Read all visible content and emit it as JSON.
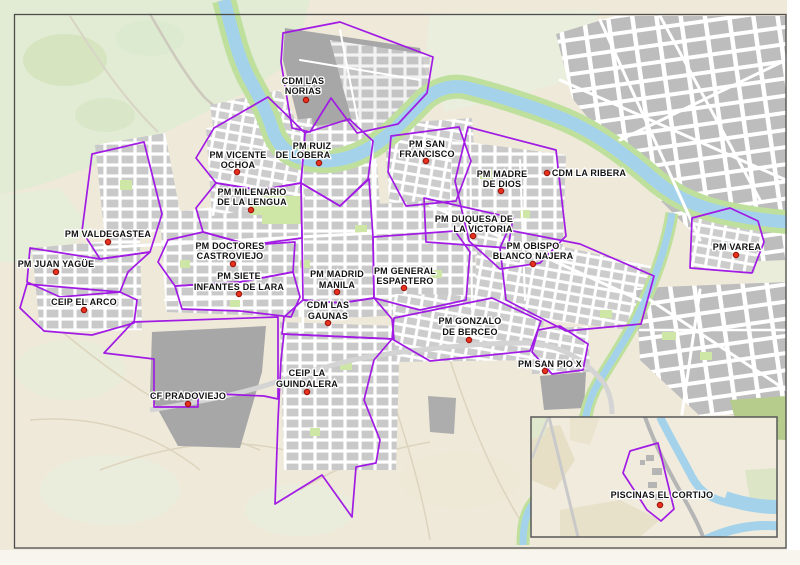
{
  "map": {
    "kind": "municipal sports facilities zone map",
    "colors": {
      "zone_boundary": "#A11BE4",
      "marker": "#E8311F",
      "river": "#A3D2EA",
      "park": "#BFE09C",
      "urban_block": "#C9C9C9",
      "industrial": "#A7A7A7",
      "farmland": "#EFE9DA",
      "countryside": "#E2EBD3",
      "border": "#4D4D4D"
    },
    "markers": [
      {
        "id": "cdm-las-norias",
        "label": "CDM LAS NORIAS",
        "line1": "CDM LAS",
        "line2": "NORIAS"
      },
      {
        "id": "pm-vicente-ochoa",
        "label": "PM VICENTE OCHOA",
        "line1": "PM VICENTE",
        "line2": "OCHOA"
      },
      {
        "id": "pm-ruiz-de-lobera",
        "label": "PM RUIZ DE LOBERA",
        "line1": "PM RUIZ",
        "line2": "DE LOBERA"
      },
      {
        "id": "pm-san-francisco",
        "label": "PM SAN FRANCISCO",
        "line1": "PM SAN",
        "line2": "FRANCISCO"
      },
      {
        "id": "pm-madre-de-dios",
        "label": "PM MADRE DE DIOS",
        "line1": "PM MADRE",
        "line2": "DE DIOS"
      },
      {
        "id": "cdm-la-ribera",
        "label": "CDM LA RIBERA",
        "line1": "CDM LA RIBERA"
      },
      {
        "id": "pm-milenario-de-la-lengua",
        "label": "PM MILENARIO DE LA LENGUA",
        "line1": "PM MILENARIO",
        "line2": "DE LA LENGUA"
      },
      {
        "id": "pm-duquesa-de-la-victoria",
        "label": "PM DUQUESA DE LA VICTORIA",
        "line1": "PM DUQUESA DE",
        "line2": "LA VICTORIA"
      },
      {
        "id": "pm-obispo-blanco-najera",
        "label": "PM OBISPO BLANCO NAJERA",
        "line1": "PM OBISPO",
        "line2": "BLANCO NAJERA"
      },
      {
        "id": "pm-varea",
        "label": "PM VAREA",
        "line1": "PM VAREA"
      },
      {
        "id": "pm-valdegastea",
        "label": "PM VALDEGASTEA",
        "line1": "PM VALDEGASTEA"
      },
      {
        "id": "pm-juan-yague",
        "label": "PM JUAN YAGÜE",
        "line1": "PM JUAN YAGÜE"
      },
      {
        "id": "ceip-el-arco",
        "label": "CEIP EL ARCO",
        "line1": "CEIP EL ARCO"
      },
      {
        "id": "pm-doctores-castroviejo",
        "label": "PM DOCTORES CASTROVIEJO",
        "line1": "PM DOCTORES",
        "line2": "CASTROVIEJO"
      },
      {
        "id": "pm-siete-infantes-de-lara",
        "label": "PM SIETE INFANTES DE LARA",
        "line1": "PM SIETE",
        "line2": "INFANTES DE LARA"
      },
      {
        "id": "pm-madrid-manila",
        "label": "PM MADRID MANILA",
        "line1": "PM MADRID",
        "line2": "MANILA"
      },
      {
        "id": "pm-general-espartero",
        "label": "PM GENERAL ESPARTERO",
        "line1": "PM GENERAL",
        "line2": "ESPARTERO"
      },
      {
        "id": "cdm-las-gaunas",
        "label": "CDM LAS GAUNAS",
        "line1": "CDM LAS",
        "line2": "GAUNAS"
      },
      {
        "id": "pm-gonzalo-de-berceo",
        "label": "PM GONZALO DE BERCEO",
        "line1": "PM GONZALO",
        "line2": "DE BERCEO"
      },
      {
        "id": "pm-san-pio-x",
        "label": "PM SAN PIO X",
        "line1": "PM SAN PIO X"
      },
      {
        "id": "ceip-la-guindalera",
        "label": "CEIP LA GUINDALERA",
        "line1": "CEIP LA",
        "line2": "GUINDALERA"
      },
      {
        "id": "cf-pradoviejo",
        "label": "CF PRADOVIEJO",
        "line1": "CF PRADOVIEJO"
      },
      {
        "id": "piscinas-el-cortijo",
        "label": "PISCINAS EL CORTIJO",
        "line1": "PISCINAS EL CORTIJO",
        "in_inset": true
      }
    ]
  }
}
